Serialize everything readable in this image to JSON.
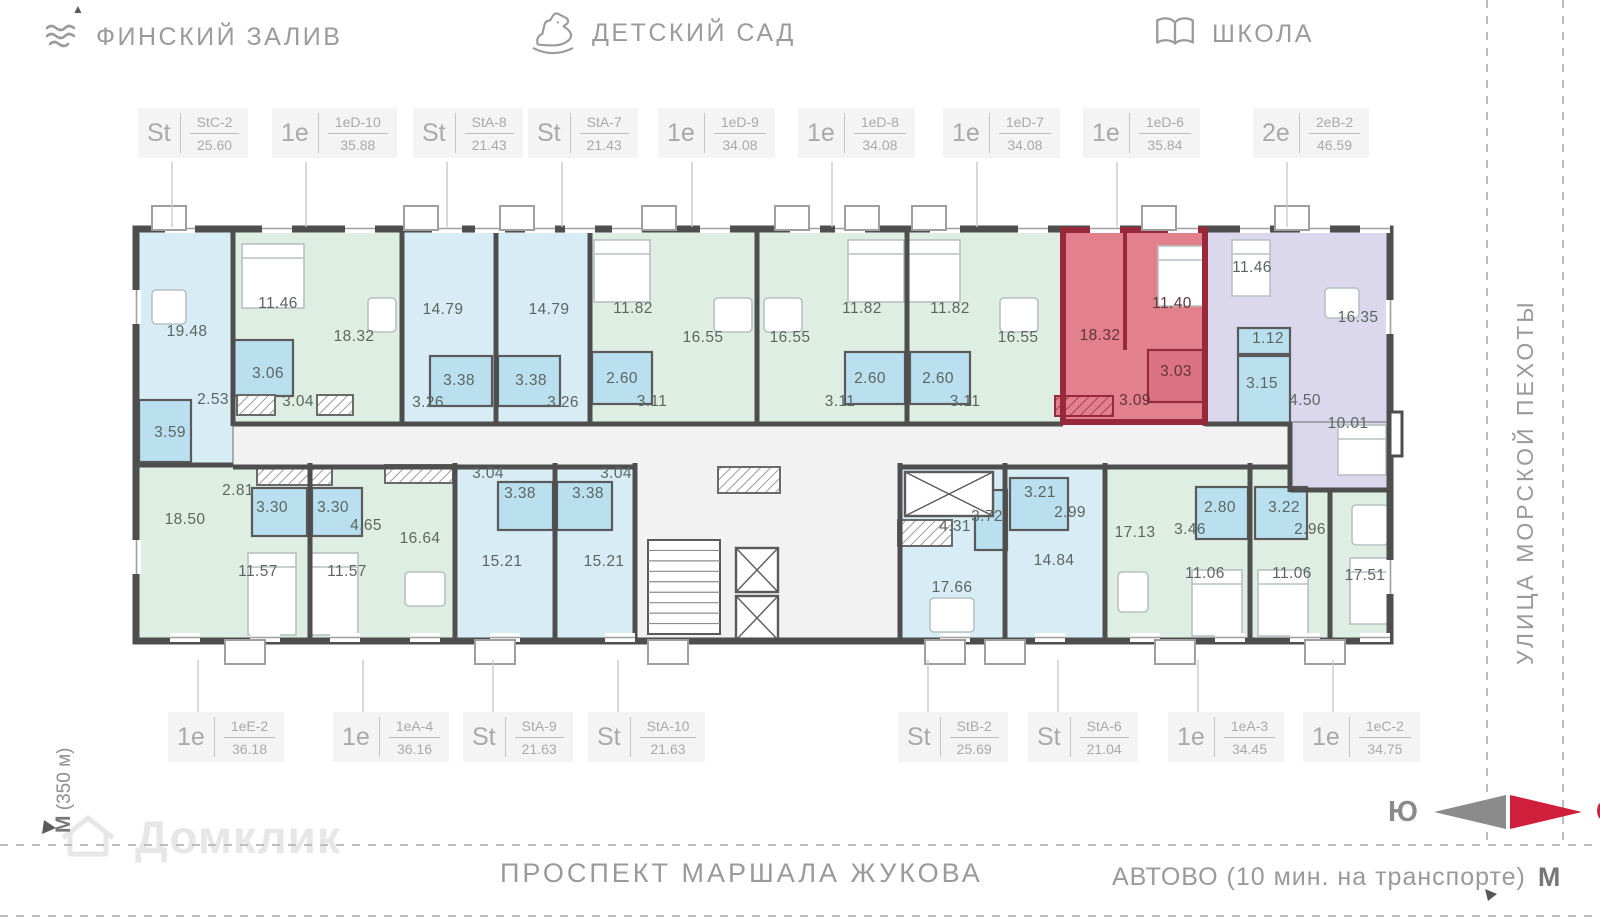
{
  "landmarks": [
    {
      "icon": "waves-icon",
      "label": "ФИНСКИЙ ЗАЛИВ"
    },
    {
      "icon": "rocking-horse-icon",
      "label": "ДЕТСКИЙ САД"
    },
    {
      "icon": "book-icon",
      "label": "ШКОЛА"
    }
  ],
  "streets": {
    "right": "УЛИЦА МОРСКОЙ ПЕХОТЫ",
    "bottom": "ПРОСПЕКТ МАРШАЛА ЖУКОВА"
  },
  "metro": {
    "bottom_label": "АВТОВО (10 мин. на транспорте)",
    "bottom_symbol": "М",
    "left_label": " (350 м)",
    "left_symbol": "М"
  },
  "compass": {
    "south": "Ю",
    "north": "С"
  },
  "watermark": {
    "label": "Домклик"
  },
  "highlight": {
    "code": "1eD-6",
    "area": "35.84"
  },
  "colors": {
    "wall": "#4e4e4e",
    "blue": "#d8ecf6",
    "green": "#dfeee3",
    "purple": "#dbd8ed",
    "wet": "#badfef",
    "red_fill": "#e2808c",
    "red_wall": "#97293a",
    "red_wet": "#dc7383",
    "corridor": "#f2f2f2",
    "accent_red": "#cf1f3a",
    "gray_text": "#9b9b9b",
    "label_text": "#5c6661"
  },
  "unit_labels": {
    "top_y": 108,
    "bottom_y": 712,
    "top": [
      {
        "type": "St",
        "code": "StC-2",
        "area": "25.60",
        "left": 138
      },
      {
        "type": "1е",
        "code": "1еD-10",
        "area": "35.88",
        "left": 272
      },
      {
        "type": "St",
        "code": "StA-8",
        "area": "21.43",
        "left": 413
      },
      {
        "type": "St",
        "code": "StA-7",
        "area": "21.43",
        "left": 528
      },
      {
        "type": "1е",
        "code": "1еD-9",
        "area": "34.08",
        "left": 658
      },
      {
        "type": "1е",
        "code": "1еD-8",
        "area": "34.08",
        "left": 798
      },
      {
        "type": "1е",
        "code": "1еD-7",
        "area": "34.08",
        "left": 943
      },
      {
        "type": "1е",
        "code": "1еD-6",
        "area": "35.84",
        "left": 1083
      },
      {
        "type": "2е",
        "code": "2еВ-2",
        "area": "46.59",
        "left": 1253
      }
    ],
    "bottom": [
      {
        "type": "1е",
        "code": "1еЕ-2",
        "area": "36.18",
        "left": 168
      },
      {
        "type": "1е",
        "code": "1еА-4",
        "area": "36.16",
        "left": 333
      },
      {
        "type": "St",
        "code": "StA-9",
        "area": "21.63",
        "left": 463
      },
      {
        "type": "St",
        "code": "StA-10",
        "area": "21.63",
        "left": 588
      },
      {
        "type": "St",
        "code": "StB-2",
        "area": "25.69",
        "left": 898
      },
      {
        "type": "St",
        "code": "StA-6",
        "area": "21.04",
        "left": 1028
      },
      {
        "type": "1е",
        "code": "1еА-3",
        "area": "34.45",
        "left": 1168
      },
      {
        "type": "1е",
        "code": "1еС-2",
        "area": "34.75",
        "left": 1303
      }
    ]
  },
  "plan": {
    "outer": [
      136,
      229,
      1254,
      412
    ],
    "corridor": [
      233,
      422,
      1057,
      45
    ],
    "core": [
      635,
      467,
      265,
      173
    ],
    "blocks": [
      [
        "StC-2",
        139,
        232,
        94,
        232,
        "blue"
      ],
      [
        "1eD-10",
        233,
        232,
        169,
        190,
        "green"
      ],
      [
        "StA-8",
        402,
        232,
        94,
        190,
        "blue"
      ],
      [
        "StA-7",
        496,
        232,
        94,
        190,
        "blue"
      ],
      [
        "1eD-9",
        590,
        232,
        167,
        190,
        "green"
      ],
      [
        "1eD-8",
        757,
        232,
        150,
        190,
        "green"
      ],
      [
        "1eD-7",
        907,
        232,
        156,
        190,
        "green"
      ],
      [
        "1eD-6",
        1063,
        232,
        142,
        190,
        "red"
      ],
      [
        "2eB-2",
        1205,
        232,
        185,
        190,
        "purple"
      ],
      [
        "1eE-2",
        139,
        467,
        171,
        173,
        "green"
      ],
      [
        "1eA-4",
        310,
        467,
        145,
        173,
        "green"
      ],
      [
        "StA-9",
        455,
        467,
        100,
        173,
        "blue"
      ],
      [
        "StA-10",
        555,
        467,
        80,
        173,
        "blue"
      ],
      [
        "StB-2",
        900,
        467,
        105,
        173,
        "blue"
      ],
      [
        "StA-6",
        1005,
        467,
        100,
        173,
        "blue"
      ],
      [
        "1eA-3",
        1105,
        467,
        145,
        173,
        "green"
      ],
      [
        "1eC-2",
        1250,
        467,
        140,
        173,
        "green"
      ],
      [
        "2eB-2-ext",
        1290,
        422,
        100,
        68,
        "purple"
      ]
    ],
    "wet_rooms": [
      [
        139,
        400,
        52,
        62,
        0
      ],
      [
        233,
        340,
        60,
        56,
        0
      ],
      [
        430,
        356,
        62,
        50,
        0
      ],
      [
        498,
        356,
        62,
        50,
        0
      ],
      [
        592,
        352,
        60,
        52,
        0
      ],
      [
        845,
        352,
        60,
        52,
        0
      ],
      [
        910,
        352,
        60,
        52,
        0
      ],
      [
        1148,
        350,
        55,
        52,
        1
      ],
      [
        1238,
        328,
        52,
        26,
        0
      ],
      [
        1238,
        356,
        52,
        68,
        0
      ],
      [
        1010,
        478,
        58,
        52,
        0
      ],
      [
        975,
        490,
        32,
        60,
        0
      ],
      [
        252,
        488,
        55,
        48,
        0
      ],
      [
        312,
        488,
        50,
        48,
        0
      ],
      [
        498,
        482,
        55,
        48,
        0
      ],
      [
        557,
        482,
        55,
        48,
        0
      ],
      [
        1196,
        487,
        52,
        52,
        0
      ],
      [
        1255,
        487,
        52,
        52,
        0
      ]
    ],
    "beds": [
      [
        242,
        244,
        62,
        64
      ],
      [
        594,
        240,
        56,
        62
      ],
      [
        848,
        240,
        56,
        62
      ],
      [
        908,
        240,
        52,
        62
      ],
      [
        1158,
        246,
        46,
        60
      ],
      [
        1232,
        240,
        38,
        56
      ],
      [
        1338,
        425,
        48,
        50
      ],
      [
        248,
        553,
        48,
        82
      ],
      [
        310,
        553,
        48,
        82
      ],
      [
        1192,
        570,
        50,
        66
      ],
      [
        1258,
        570,
        50,
        66
      ],
      [
        1350,
        558,
        38,
        66
      ]
    ],
    "tables": [
      [
        152,
        290,
        34,
        34
      ],
      [
        368,
        298,
        28,
        34
      ],
      [
        714,
        298,
        38,
        34
      ],
      [
        764,
        298,
        38,
        34
      ],
      [
        1000,
        298,
        38,
        34
      ],
      [
        1325,
        288,
        34,
        30
      ],
      [
        405,
        572,
        40,
        34
      ],
      [
        930,
        598,
        44,
        34
      ],
      [
        1118,
        572,
        30,
        40
      ],
      [
        1352,
        505,
        36,
        40
      ]
    ],
    "hatches": [
      [
        237,
        395,
        38,
        20,
        0
      ],
      [
        317,
        395,
        36,
        20,
        0
      ],
      [
        718,
        467,
        62,
        26,
        0
      ],
      [
        898,
        520,
        54,
        26,
        0
      ],
      [
        1055,
        396,
        58,
        20,
        1
      ],
      [
        257,
        467,
        75,
        18,
        0
      ],
      [
        385,
        465,
        68,
        18,
        0
      ]
    ],
    "xboxes": [
      [
        905,
        472,
        88,
        44
      ],
      [
        736,
        548,
        42,
        44
      ],
      [
        736,
        596,
        42,
        44
      ]
    ],
    "stairs": [
      648,
      540,
      72,
      94
    ],
    "walls_h": [
      [
        233,
        424,
        1063
      ],
      [
        1205,
        424,
        1290
      ],
      [
        233,
        467,
        635
      ],
      [
        900,
        467,
        1290
      ],
      [
        1290,
        490,
        1390
      ],
      [
        139,
        465,
        233
      ]
    ],
    "walls_v": [
      [
        233,
        228,
        426
      ],
      [
        402,
        228,
        426
      ],
      [
        496,
        228,
        426
      ],
      [
        590,
        228,
        426
      ],
      [
        757,
        228,
        426
      ],
      [
        907,
        228,
        426
      ],
      [
        1205,
        228,
        426
      ],
      [
        310,
        463,
        642
      ],
      [
        455,
        463,
        642
      ],
      [
        555,
        463,
        642
      ],
      [
        635,
        463,
        642
      ],
      [
        900,
        463,
        642
      ],
      [
        1005,
        463,
        642
      ],
      [
        1105,
        463,
        642
      ],
      [
        1250,
        463,
        642
      ],
      [
        1290,
        422,
        492
      ],
      [
        1330,
        490,
        642
      ]
    ],
    "red_outline": [
      1063,
      230,
      142,
      192
    ],
    "red_inner_v": [
      1125,
      232,
      350
    ],
    "windows_top_x": [
      165,
      262,
      345,
      432,
      475,
      525,
      565,
      612,
      700,
      790,
      835,
      930,
      1018,
      1090,
      1168,
      1240,
      1300,
      1360
    ],
    "windows_bottom_x": [
      170,
      250,
      330,
      410,
      490,
      605,
      940,
      1035,
      1130,
      1215,
      1290,
      1360
    ],
    "windows_left_y": [
      290,
      540
    ],
    "windows_right_y": [
      300,
      560
    ],
    "balconies_top_x": [
      152,
      404,
      500,
      642,
      775,
      845,
      912,
      1142,
      1275
    ],
    "balconies_bottom_x": [
      225,
      475,
      648,
      925,
      985,
      1155,
      1305
    ],
    "right_bump": [
      1390,
      412,
      12,
      44
    ],
    "rooms": [
      {
        "t": "19.48",
        "x": 187,
        "y": 336
      },
      {
        "t": "2.53",
        "x": 213,
        "y": 404
      },
      {
        "t": "3.59",
        "x": 170,
        "y": 437
      },
      {
        "t": "11.46",
        "x": 278,
        "y": 308
      },
      {
        "t": "18.32",
        "x": 354,
        "y": 341
      },
      {
        "t": "3.06",
        "x": 268,
        "y": 378
      },
      {
        "t": "3.04",
        "x": 298,
        "y": 406
      },
      {
        "t": "14.79",
        "x": 443,
        "y": 314
      },
      {
        "t": "3.38",
        "x": 459,
        "y": 385
      },
      {
        "t": "3.26",
        "x": 428,
        "y": 407
      },
      {
        "t": "14.79",
        "x": 549,
        "y": 314
      },
      {
        "t": "3.38",
        "x": 531,
        "y": 385
      },
      {
        "t": "3.26",
        "x": 563,
        "y": 407
      },
      {
        "t": "11.82",
        "x": 633,
        "y": 313
      },
      {
        "t": "16.55",
        "x": 703,
        "y": 342
      },
      {
        "t": "2.60",
        "x": 622,
        "y": 383
      },
      {
        "t": "3.11",
        "x": 652,
        "y": 406
      },
      {
        "t": "16.55",
        "x": 790,
        "y": 342
      },
      {
        "t": "11.82",
        "x": 862,
        "y": 313
      },
      {
        "t": "2.60",
        "x": 870,
        "y": 383
      },
      {
        "t": "3.11",
        "x": 840,
        "y": 406
      },
      {
        "t": "11.82",
        "x": 950,
        "y": 313
      },
      {
        "t": "16.55",
        "x": 1018,
        "y": 342
      },
      {
        "t": "2.60",
        "x": 938,
        "y": 383
      },
      {
        "t": "3.11",
        "x": 965,
        "y": 406
      },
      {
        "t": "18.32",
        "x": 1100,
        "y": 340,
        "r": 1
      },
      {
        "t": "11.40",
        "x": 1172,
        "y": 308,
        "r": 1
      },
      {
        "t": "3.03",
        "x": 1176,
        "y": 376,
        "r": 1
      },
      {
        "t": "3.09",
        "x": 1135,
        "y": 405,
        "r": 1
      },
      {
        "t": "11.46",
        "x": 1252,
        "y": 272
      },
      {
        "t": "1.12",
        "x": 1268,
        "y": 343
      },
      {
        "t": "3.15",
        "x": 1262,
        "y": 388
      },
      {
        "t": "4.50",
        "x": 1305,
        "y": 405
      },
      {
        "t": "16.35",
        "x": 1358,
        "y": 322
      },
      {
        "t": "10.01",
        "x": 1348,
        "y": 428
      },
      {
        "t": "18.50",
        "x": 185,
        "y": 524
      },
      {
        "t": "2.81",
        "x": 238,
        "y": 495
      },
      {
        "t": "3.30",
        "x": 272,
        "y": 512
      },
      {
        "t": "11.57",
        "x": 258,
        "y": 576
      },
      {
        "t": "3.30",
        "x": 333,
        "y": 512
      },
      {
        "t": "4.65",
        "x": 366,
        "y": 530
      },
      {
        "t": "16.64",
        "x": 420,
        "y": 543
      },
      {
        "t": "11.57",
        "x": 347,
        "y": 576
      },
      {
        "t": "3.04",
        "x": 488,
        "y": 478
      },
      {
        "t": "3.38",
        "x": 520,
        "y": 498
      },
      {
        "t": "15.21",
        "x": 502,
        "y": 566
      },
      {
        "t": "3.04",
        "x": 616,
        "y": 478
      },
      {
        "t": "3.38",
        "x": 588,
        "y": 498
      },
      {
        "t": "15.21",
        "x": 604,
        "y": 566
      },
      {
        "t": "3.72",
        "x": 987,
        "y": 521
      },
      {
        "t": "4.31",
        "x": 955,
        "y": 531
      },
      {
        "t": "17.66",
        "x": 952,
        "y": 592
      },
      {
        "t": "3.21",
        "x": 1040,
        "y": 497
      },
      {
        "t": "2.99",
        "x": 1070,
        "y": 517
      },
      {
        "t": "14.84",
        "x": 1054,
        "y": 565
      },
      {
        "t": "17.13",
        "x": 1135,
        "y": 537
      },
      {
        "t": "3.46",
        "x": 1190,
        "y": 534
      },
      {
        "t": "2.80",
        "x": 1220,
        "y": 512
      },
      {
        "t": "11.06",
        "x": 1205,
        "y": 578
      },
      {
        "t": "3.22",
        "x": 1284,
        "y": 512
      },
      {
        "t": "2.96",
        "x": 1310,
        "y": 534
      },
      {
        "t": "11.06",
        "x": 1292,
        "y": 578
      },
      {
        "t": "17.51",
        "x": 1365,
        "y": 580
      }
    ],
    "dashed": {
      "h_lines_y": [
        845,
        916
      ],
      "v_lines_x": [
        1487,
        1563
      ],
      "v_lines_y2": 845
    }
  }
}
